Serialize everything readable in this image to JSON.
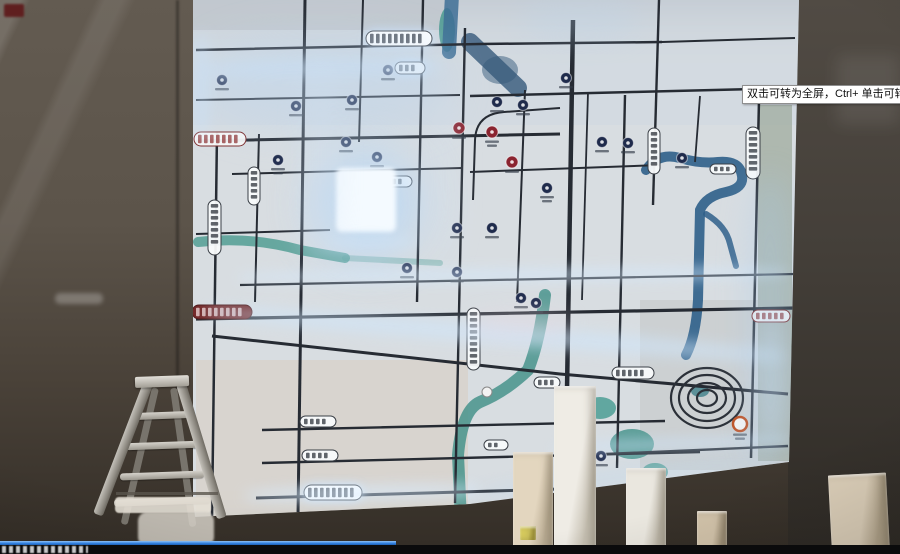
{
  "player": {
    "tooltip_text": "双击可转为全屏，Ctrl+ 单击可转为",
    "progress_fraction": 0.44,
    "colors": {
      "progress": "#2f7fe0",
      "bar": "#0b0b0c"
    }
  },
  "scene": {
    "colors": {
      "board_base": "#d8dde1",
      "road": "#262b33",
      "river_blue": "#2f5f8a",
      "canal_teal": "#449a90",
      "poi_navy": "#1f2b4c",
      "poi_red": "#8a2430",
      "poi_orange": "#c05224",
      "glow": "#cfe6ff",
      "wall_left": "#5c544a",
      "wall_right": "#3b3631"
    },
    "roads": [
      {
        "d": "M196 50 L480 44 L662 42",
        "w": 2.5
      },
      {
        "d": "M662 42 L795 38",
        "w": 2
      },
      {
        "d": "M196 100 L460 95",
        "w": 2
      },
      {
        "d": "M470 96 L795 88",
        "w": 2.5
      },
      {
        "d": "M196 141 L560 134",
        "w": 3
      },
      {
        "d": "M232 174 L462 168",
        "w": 2
      },
      {
        "d": "M470 172 L660 165",
        "w": 2
      },
      {
        "d": "M196 234 L330 230",
        "w": 2
      },
      {
        "d": "M240 285 L795 274",
        "w": 2.2
      },
      {
        "d": "M196 319 L795 308",
        "w": 3.2
      },
      {
        "d": "M212 336 L560 374 L788 394",
        "w": 3
      },
      {
        "d": "M262 430 L665 421",
        "w": 2.4
      },
      {
        "d": "M262 463 L700 452",
        "w": 2.4
      },
      {
        "d": "M256 498 L560 489",
        "w": 3
      },
      {
        "d": "M560 456 L788 446",
        "w": 2.4
      },
      {
        "d": "M560 108 L504 112 Q476 114 475 140 L473 200",
        "w": 2
      },
      {
        "d": "M217 132 L212 517",
        "w": 2.5
      },
      {
        "d": "M259 134 L255 302",
        "w": 2
      },
      {
        "d": "M305 0 L298 516",
        "w": 3
      },
      {
        "d": "M363 0 L359 142",
        "w": 2
      },
      {
        "d": "M423 0 L417 302",
        "w": 2.4
      },
      {
        "d": "M465 28 L455 503",
        "w": 2.4
      },
      {
        "d": "M525 90 L517 302",
        "w": 2
      },
      {
        "d": "M573 20 L566 452",
        "w": 4.5
      },
      {
        "d": "M588 92 L582 300",
        "w": 1.8
      },
      {
        "d": "M625 95 L617 468",
        "w": 2.4
      },
      {
        "d": "M659 0 L653 205",
        "w": 2.4
      },
      {
        "d": "M700 96 L695 162",
        "w": 1.8
      },
      {
        "d": "M759 100 L751 458",
        "w": 2.5
      }
    ],
    "rivers": [
      {
        "d": "M452 -5 L449 52",
        "w": 14,
        "c": "#3e6f95",
        "o": 0.85
      },
      {
        "d": "M470 42 L518 88",
        "w": 18,
        "c": "#36597b",
        "o": 0.8
      },
      {
        "d": "M646 170 Q658 152 680 158 Q700 164 718 162 Q740 160 742 176 Q744 188 726 192 Q706 196 700 210 L698 300 Q696 336 686 355",
        "w": 10,
        "c": "#2f5f8a",
        "o": 0.9
      },
      {
        "d": "M706 214 Q726 226 730 244 L736 266",
        "w": 6,
        "c": "#2f5f8a",
        "o": 0.85
      },
      {
        "d": "M545 295 Q540 340 528 370 Q505 392 480 402 Q462 410 458 455 L461 520",
        "w": 12,
        "c": "#3f8f86",
        "o": 0.8
      },
      {
        "d": "M198 242 Q250 236 300 250 L345 258",
        "w": 10,
        "c": "#4a9a8f",
        "o": 0.8
      },
      {
        "d": "M345 258 L440 263",
        "w": 6,
        "c": "#4a9a8f",
        "o": 0.4
      }
    ],
    "areas": [
      {
        "t": "e",
        "x": 447,
        "y": 30,
        "rx": 8,
        "ry": 22,
        "c": "#4a9a90",
        "o": 0.85
      },
      {
        "t": "e",
        "x": 500,
        "y": 70,
        "rx": 18,
        "ry": 14,
        "c": "#36597b",
        "o": 0.5
      },
      {
        "t": "e",
        "x": 600,
        "y": 408,
        "rx": 16,
        "ry": 11,
        "c": "#449a90",
        "o": 0.8
      },
      {
        "t": "e",
        "x": 632,
        "y": 444,
        "rx": 22,
        "ry": 15,
        "c": "#3f8f86",
        "o": 0.8
      },
      {
        "t": "e",
        "x": 655,
        "y": 472,
        "rx": 13,
        "ry": 9,
        "c": "#449a90",
        "o": 0.7
      },
      {
        "t": "e",
        "x": 583,
        "y": 398,
        "rx": 10,
        "ry": 7,
        "c": "#449a90",
        "o": 0.6
      },
      {
        "t": "e",
        "x": 700,
        "y": 391,
        "rx": 9,
        "ry": 6,
        "c": "#3f7f8a",
        "o": 0.8
      }
    ],
    "rings": {
      "cx": 707,
      "cy": 398,
      "stroke": "#2b3038",
      "list": [
        [
          36,
          30
        ],
        [
          28,
          23
        ],
        [
          19,
          15
        ],
        [
          10,
          8
        ]
      ]
    },
    "pois": [
      {
        "x": 222,
        "y": 80,
        "s": "navy"
      },
      {
        "x": 296,
        "y": 106,
        "s": "navy"
      },
      {
        "x": 352,
        "y": 100,
        "s": "navy"
      },
      {
        "x": 388,
        "y": 70,
        "s": "navy"
      },
      {
        "x": 278,
        "y": 160,
        "s": "navy",
        "lines": 2
      },
      {
        "x": 346,
        "y": 142,
        "s": "navy"
      },
      {
        "x": 377,
        "y": 157,
        "s": "navy"
      },
      {
        "x": 497,
        "y": 102,
        "s": "navy"
      },
      {
        "x": 523,
        "y": 105,
        "s": "navy"
      },
      {
        "x": 547,
        "y": 188,
        "s": "navy",
        "lines": 2
      },
      {
        "x": 457,
        "y": 228,
        "s": "navy"
      },
      {
        "x": 492,
        "y": 228,
        "s": "navy"
      },
      {
        "x": 407,
        "y": 268,
        "s": "navy"
      },
      {
        "x": 457,
        "y": 272,
        "s": "navy"
      },
      {
        "x": 521,
        "y": 298,
        "s": "navy"
      },
      {
        "x": 536,
        "y": 303,
        "s": "navy"
      },
      {
        "x": 602,
        "y": 142,
        "s": "navy"
      },
      {
        "x": 628,
        "y": 143,
        "s": "navy"
      },
      {
        "x": 682,
        "y": 158,
        "s": "navy"
      },
      {
        "x": 601,
        "y": 456,
        "s": "navy"
      },
      {
        "x": 566,
        "y": 78,
        "s": "navy"
      },
      {
        "x": 459,
        "y": 128,
        "s": "red"
      },
      {
        "x": 492,
        "y": 132,
        "s": "red",
        "lines": 2
      },
      {
        "x": 512,
        "y": 162,
        "s": "red"
      },
      {
        "x": 740,
        "y": 424,
        "s": "orange",
        "lines": 2
      },
      {
        "x": 487,
        "y": 392,
        "s": "white",
        "lines": 0
      }
    ],
    "labels": [
      {
        "x": 366,
        "y": 31,
        "w": 66,
        "h": 15,
        "dir": "h",
        "s": "glow"
      },
      {
        "x": 395,
        "y": 62,
        "w": 30,
        "h": 12,
        "dir": "h",
        "s": "glow"
      },
      {
        "x": 194,
        "y": 132,
        "w": 52,
        "h": 14,
        "dir": "h",
        "s": "red-accent"
      },
      {
        "x": 192,
        "y": 305,
        "w": 60,
        "h": 14,
        "dir": "h",
        "s": "dark-red"
      },
      {
        "x": 752,
        "y": 310,
        "w": 38,
        "h": 12,
        "dir": "h",
        "s": "red-accent"
      },
      {
        "x": 300,
        "y": 416,
        "w": 36,
        "h": 11,
        "dir": "h",
        "s": "plain"
      },
      {
        "x": 302,
        "y": 450,
        "w": 36,
        "h": 11,
        "dir": "h",
        "s": "plain"
      },
      {
        "x": 304,
        "y": 485,
        "w": 58,
        "h": 15,
        "dir": "h",
        "s": "glow"
      },
      {
        "x": 612,
        "y": 367,
        "w": 42,
        "h": 12,
        "dir": "h",
        "s": "plain"
      },
      {
        "x": 382,
        "y": 176,
        "w": 30,
        "h": 11,
        "dir": "h",
        "s": "plain"
      },
      {
        "x": 534,
        "y": 377,
        "w": 26,
        "h": 11,
        "dir": "h",
        "s": "plain"
      },
      {
        "x": 484,
        "y": 440,
        "w": 24,
        "h": 10,
        "dir": "h",
        "s": "plain"
      },
      {
        "x": 710,
        "y": 164,
        "w": 26,
        "h": 10,
        "dir": "h",
        "s": "plain"
      },
      {
        "x": 208,
        "y": 200,
        "w": 13,
        "h": 55,
        "dir": "v",
        "s": "plain"
      },
      {
        "x": 248,
        "y": 167,
        "w": 12,
        "h": 38,
        "dir": "v",
        "s": "plain"
      },
      {
        "x": 467,
        "y": 308,
        "w": 13,
        "h": 62,
        "dir": "v",
        "s": "plain"
      },
      {
        "x": 746,
        "y": 127,
        "w": 14,
        "h": 52,
        "dir": "v",
        "s": "plain"
      },
      {
        "x": 648,
        "y": 128,
        "w": 12,
        "h": 46,
        "dir": "v",
        "s": "plain"
      }
    ],
    "glows": [
      {
        "x": 312,
        "y": 148,
        "w": 110,
        "h": 110,
        "c": "#bcd9f5",
        "b": 22,
        "o": 0.8,
        "r": "50%"
      },
      {
        "x": 336,
        "y": 168,
        "w": 60,
        "h": 64,
        "c": "#f4faff",
        "b": 2,
        "o": 1,
        "r": "6px"
      },
      {
        "x": 205,
        "y": 60,
        "w": 235,
        "h": 16,
        "c": "#cfe4f8",
        "b": 7,
        "o": 0.6,
        "rot": -1
      },
      {
        "x": 200,
        "y": 36,
        "w": 250,
        "h": 95,
        "c": "#b9d4ee",
        "b": 20,
        "o": 0.35
      },
      {
        "x": 194,
        "y": 34,
        "w": 14,
        "h": 105,
        "c": "#c9e2fa",
        "b": 7,
        "o": 0.55
      },
      {
        "x": 238,
        "y": 268,
        "w": 550,
        "h": 14,
        "c": "#d5e9fc",
        "b": 6,
        "o": 0.55,
        "rot": -0.5
      },
      {
        "x": 205,
        "y": 325,
        "w": 580,
        "h": 18,
        "c": "#cfe6fb",
        "b": 7,
        "o": 0.6,
        "rot": 4.5
      },
      {
        "x": 326,
        "y": 236,
        "w": 90,
        "h": 12,
        "c": "#cfe4f8",
        "b": 6,
        "o": 0.5
      },
      {
        "x": 553,
        "y": 438,
        "w": 240,
        "h": 12,
        "c": "#cde4fa",
        "b": 6,
        "o": 0.5,
        "rot": -2
      },
      {
        "x": 748,
        "y": 175,
        "w": 44,
        "h": 290,
        "c": "#aaccec",
        "b": 16,
        "o": 0.35
      },
      {
        "x": 245,
        "y": 486,
        "w": 235,
        "h": 14,
        "c": "#d8ecff",
        "b": 7,
        "o": 0.65,
        "rot": -1.5
      },
      {
        "x": 470,
        "y": 312,
        "w": 100,
        "h": 24,
        "c": "#e8d9e4",
        "b": 10,
        "o": 0.4
      },
      {
        "x": 480,
        "y": 470,
        "w": 300,
        "h": 12,
        "c": "#bdd8f0",
        "b": 8,
        "o": 0.45,
        "rot": -7
      },
      {
        "x": 520,
        "y": 0,
        "w": 120,
        "h": 40,
        "c": "#bcd4ea",
        "b": 14,
        "o": 0.3
      },
      {
        "x": 300,
        "y": 60,
        "w": 40,
        "h": 200,
        "c": "#cfe0f2",
        "b": 12,
        "o": 0.25
      },
      {
        "x": 430,
        "y": 100,
        "w": 30,
        "h": 160,
        "c": "#cfe0f2",
        "b": 12,
        "o": 0.2
      },
      {
        "x": 756,
        "y": 320,
        "w": 30,
        "h": 120,
        "c": "#cfe4fa",
        "b": 10,
        "o": 0.3
      }
    ],
    "pillars": [
      {
        "x": 513,
        "y": 452,
        "w": 40,
        "h": 102,
        "c1": "#e3d6bf",
        "c2": "#bdaf96"
      },
      {
        "x": 554,
        "y": 386,
        "w": 42,
        "h": 168,
        "c1": "#efece5",
        "c2": "#c6c0b2"
      },
      {
        "x": 626,
        "y": 468,
        "w": 40,
        "h": 86,
        "c1": "#eae7df",
        "c2": "#c2bcae"
      },
      {
        "x": 697,
        "y": 511,
        "w": 30,
        "h": 43,
        "c1": "#d2c3aa",
        "c2": "#ab9c82"
      },
      {
        "x": 830,
        "y": 474,
        "w": 58,
        "h": 80,
        "c1": "#dccfb9",
        "c2": "#b3a58c",
        "rot": -3
      },
      {
        "x": 520,
        "y": 526,
        "w": 16,
        "h": 14,
        "c1": "#d9cd5e",
        "c2": "#b5a83f"
      }
    ]
  }
}
